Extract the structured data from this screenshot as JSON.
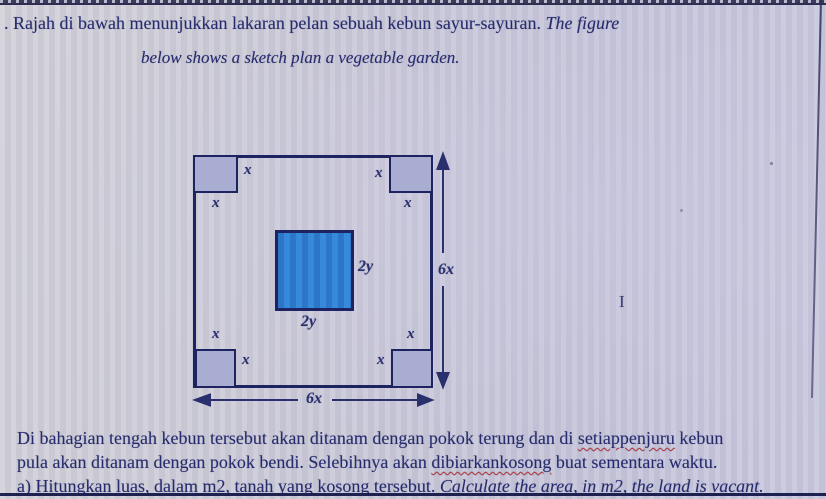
{
  "header": {
    "line1_malay": ". Rajah di bawah menunjukkan lakaran pelan sebuah kebun sayur-sayuran. ",
    "line1_english_italic": "The figure",
    "line2_english_italic": "below shows a sketch plan a vegetable garden."
  },
  "diagram": {
    "corner_label": "x",
    "center_label": "2y",
    "side_label": "6x",
    "colors": {
      "outline": "#1d2260",
      "corner_fill": "#a8add1",
      "center_fill": "#2f80cf",
      "arrow": "#2a2f6e"
    }
  },
  "cursor": {
    "glyph": "I"
  },
  "paragraph": {
    "line1_pre": "Di bahagian tengah kebun tersebut akan ditanam dengan pokok terung dan di ",
    "line1_misspelled": "setiappenjuru",
    "line1_post": " kebun",
    "line2_pre": "pula akan ditanam dengan pokok bendi. Selebihnya akan ",
    "line2_misspelled": "dibiarkankosong",
    "line2_post": " buat sementara waktu.",
    "line3_malay": "a) Hitungkan luas, dalam m2, tanah yang kosong tersebut. ",
    "line3_english_italic": "Calculate the area, in m2, the land is vacant."
  }
}
